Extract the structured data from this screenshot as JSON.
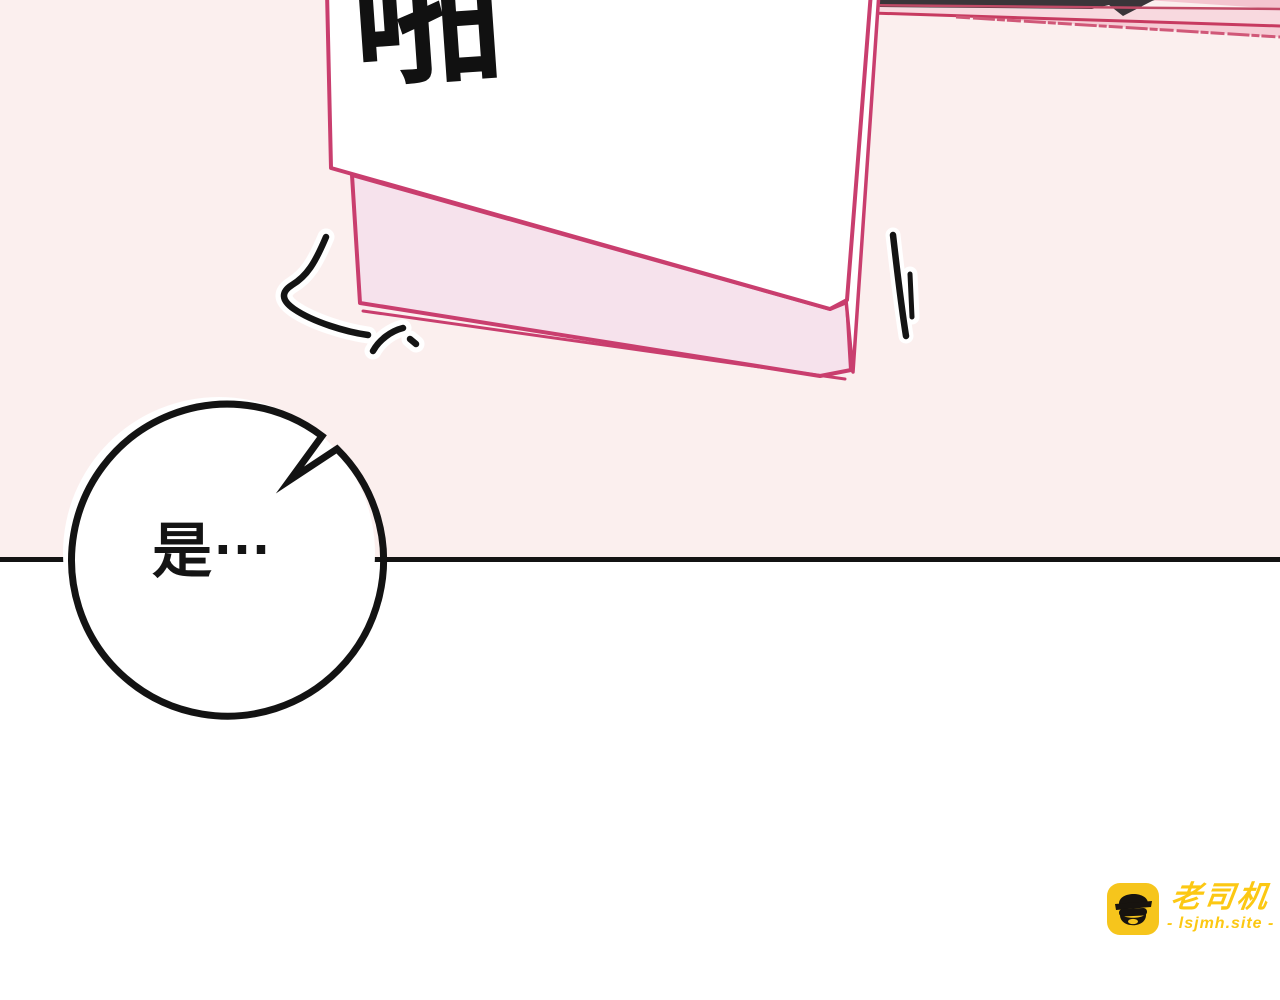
{
  "panel": {
    "upper_background": "#fbefee",
    "lower_background": "#ffffff",
    "divider_color": "#131313"
  },
  "sfx": {
    "text": "啪"
  },
  "speech_bubble": {
    "text": "是",
    "ellipsis": "…",
    "fill": "#ffffff",
    "outline_color": "#131313"
  },
  "card": {
    "border_color": "#c93e6e",
    "page_color": "#ffffff",
    "flap_color": "#f6e2ec",
    "stripe_band_color": "#f8d9df",
    "stripe_band_color_2": "#f6ccd5",
    "stripe_line_color": "#c7406a",
    "dark_object_color": "#3a3539"
  },
  "motion_marks": {
    "color": "#141414",
    "halo_color": "#ffffff"
  },
  "watermark": {
    "brand": "老司机",
    "site": "- lsjmh.site -",
    "icon": "driver-face-icon",
    "icon_background": "#f6c51c",
    "text_color": "#fcc813"
  }
}
